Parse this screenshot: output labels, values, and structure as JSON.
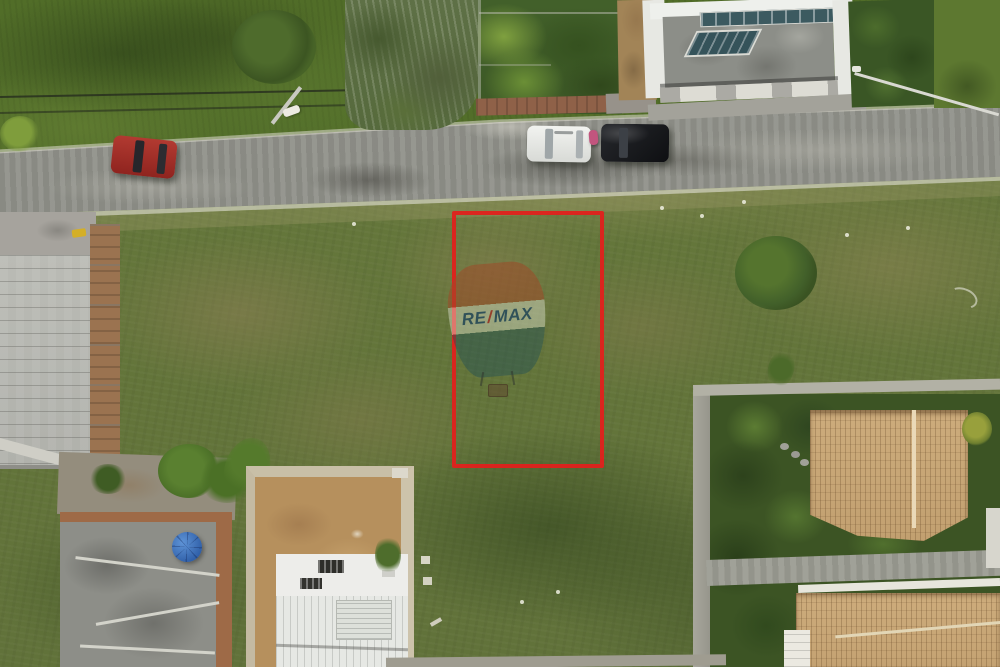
{
  "scene": {
    "type": "aerial-drone-photo",
    "description_label": "vacant land lot with red boundary outline",
    "watermark": {
      "re": "RE",
      "slash": "/",
      "max": "MAX"
    },
    "annotation": {
      "boundary_color": "#e0211c"
    },
    "palette": {
      "grass": "#64753a",
      "grass_dark": "#44591f",
      "grass_brown_patch": "#8d7f55",
      "road": "#90918a",
      "clay_tile_roof": "#c9a878",
      "metal_roof": "#b6b7b1",
      "white_building": "#e9eae6",
      "brick_wall": "#9e6a47",
      "dirt": "#b6905d",
      "red_car": "#a5322c",
      "white_car": "#e9eae6",
      "black_car": "#17191c",
      "umbrella_blue": "#3b6fb5",
      "balloon_red": "rgba(158,74,40,0.55)",
      "balloon_blue": "rgba(28,76,86,0.42)"
    },
    "objects": [
      "road",
      "red-car",
      "white-car",
      "black-car",
      "scooter",
      "power-lines",
      "street-lamp",
      "walled-garden",
      "modern-white-house",
      "hedge",
      "warehouse-roof",
      "brick-wall",
      "construction-slab-building",
      "blue-umbrella",
      "palm-tree",
      "white-house-under-construction",
      "clay-tile-house",
      "clay-tile-house-lower",
      "driveway",
      "vacant-lot",
      "red-boundary-rectangle",
      "remax-balloon-watermark"
    ]
  }
}
